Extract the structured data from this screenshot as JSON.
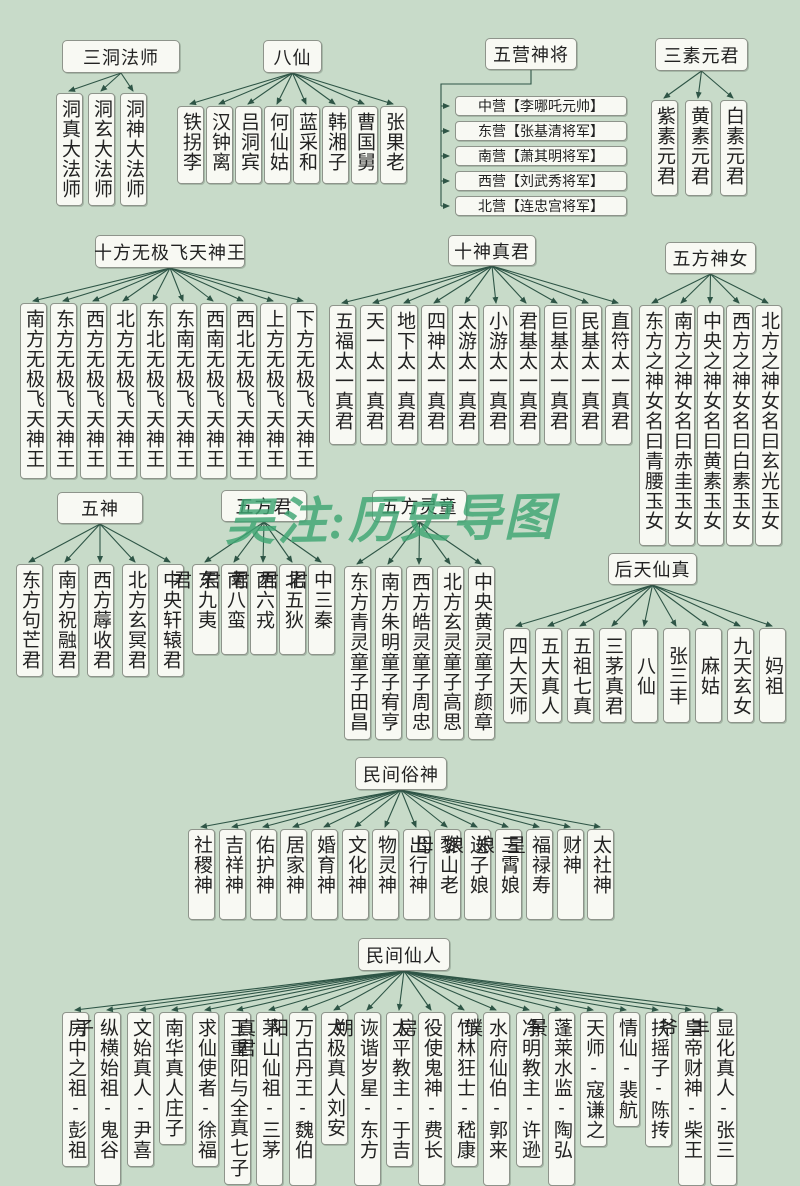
{
  "colors": {
    "background": "#c8dbc9",
    "line": "#2e5546",
    "box_fill": "#f8f9f3",
    "box_border": "#8e948b",
    "watermark": "#3fa673"
  },
  "watermark": {
    "text": "吴注:历史导图"
  },
  "sections": {
    "sandongfashi": {
      "title": "三洞法师",
      "children": [
        "洞真大法师",
        "洞玄大法师",
        "洞神大法师"
      ]
    },
    "baxian": {
      "title": "八仙",
      "children": [
        "铁拐李",
        "汉钟离",
        "吕洞宾",
        "何仙姑",
        "蓝采和",
        "韩湘子",
        "曹国舅",
        "张果老"
      ]
    },
    "wuyingshenjiang": {
      "title": "五营神将",
      "children": [
        "中营【李哪吒元帅】",
        "东营【张基清将军】",
        "南营【萧其明将军】",
        "西营【刘武秀将军】",
        "北营【连忠宫将军】"
      ]
    },
    "sansuyuanjun": {
      "title": "三素元君",
      "children": [
        "紫素元君",
        "黄素元君",
        "白素元君"
      ]
    },
    "shifang": {
      "title": "十方无极飞天神王",
      "children": [
        "南方无极飞天神王",
        "东方无极飞天神王",
        "西方无极飞天神王",
        "北方无极飞天神王",
        "东北无极飞天神王",
        "东南无极飞天神王",
        "西南无极飞天神王",
        "西北无极飞天神王",
        "上方无极飞天神王",
        "下方无极飞天神王"
      ]
    },
    "shishenzhenjun": {
      "title": "十神真君",
      "children": [
        "五福太一真君",
        "天一太一真君",
        "地下太一真君",
        "四神太一真君",
        "太游太一真君",
        "小游太一真君",
        "君基太一真君",
        "巨基太一真君",
        "民基太一真君",
        "直符太一真君"
      ]
    },
    "wufangshennv": {
      "title": "五方神女",
      "children": [
        "东方之神女名曰青腰玉女",
        "南方之神女名曰赤圭玉女",
        "中央之神女名曰黄素玉女",
        "西方之神女名曰白素玉女",
        "北方之神女名曰玄光玉女"
      ]
    },
    "wushen": {
      "title": "五神",
      "children": [
        "东方句芒君",
        "南方祝融君",
        "西方蓐收君",
        "北方玄冥君",
        "中央轩辕君"
      ]
    },
    "wufangjun": {
      "title": "五方君",
      "children": [
        "东九夷君",
        "南八蛮君",
        "西六戎君",
        "北五狄君",
        "中三秦君"
      ]
    },
    "wufanglingtong": {
      "title": "五方灵童",
      "children": [
        "东方青灵童子田昌",
        "南方朱明童子宥亨",
        "西方皓灵童子周忠",
        "北方玄灵童子高思",
        "中央黄灵童子颜章"
      ]
    },
    "houtianxianzhen": {
      "title": "后天仙真",
      "children": [
        "四大天师",
        "五大真人",
        "五祖七真",
        "三茅真君",
        "八仙",
        "张三丰",
        "麻姑",
        "九天玄女",
        "妈祖"
      ]
    },
    "minjiansushen": {
      "title": "民间俗神",
      "children": [
        "社稷神",
        "吉祥神",
        "佑护神",
        "居家神",
        "婚育神",
        "文化神",
        "物灵神",
        "出行神",
        "黎山老母",
        "送子娘娘",
        "三霄娘娘",
        "福禄寿星",
        "财神",
        "太社神"
      ]
    },
    "minjianxianren": {
      "title": "民间仙人",
      "children": [
        "房中之祖-彭祖",
        "纵横始祖-鬼谷子",
        "文始真人-尹喜",
        "南华真人庄子",
        "求仙使者-徐福",
        "王重阳与全真七子",
        "茅山仙祖-三茅真君",
        "万古丹王-魏伯阳",
        "太极真人刘安",
        "诙谐岁星-东方朔",
        "太平教主-于吉",
        "役使鬼神-费长房",
        "竹林狂士-嵇康",
        "水府仙伯-郭来璞",
        "净明教主-许逊",
        "蓬莱水监-陶弘景",
        "天师-寇谦之",
        "情仙-裴航",
        "扶摇子-陈抟",
        "皇帝财神-柴王爷",
        "显化真人-张三丰"
      ]
    }
  }
}
